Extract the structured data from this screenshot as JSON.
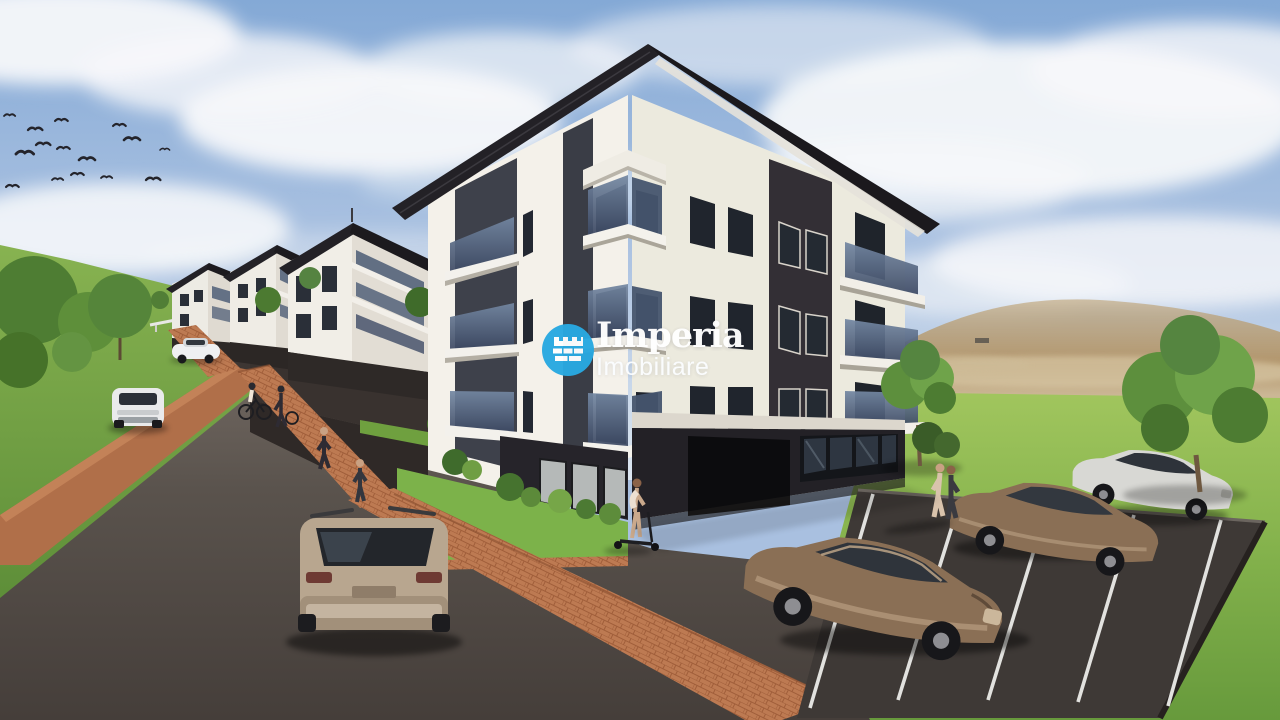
{
  "watermark": {
    "brand": "Imperia",
    "subtitle": "Imobiliare",
    "icon": "castle-crest-icon"
  },
  "palette": {
    "logo_blue": "#29a9e1",
    "sky_blue": "#9fbcdf",
    "cloud_white": "#f4f6f8",
    "facade_white": "#f4f1ea",
    "facade_shaded": "#e8e3da",
    "panel_dark": "#3a353c",
    "roof_black": "#211f23",
    "balcony_glass": "#5b6b84",
    "window_dark": "#20252d",
    "grass_green": "#8cba52",
    "lawn_green": "#7cb24a",
    "hill_tan": "#b69a6f",
    "brick_terracotta": "#b97450",
    "asphalt_gray": "#57504b",
    "parking_asphalt": "#3e3936",
    "car_bronze": "#8a6f55",
    "car_champagne": "#b8a68f",
    "car_silver": "#d8d8d4",
    "car_white": "#ebecec"
  }
}
